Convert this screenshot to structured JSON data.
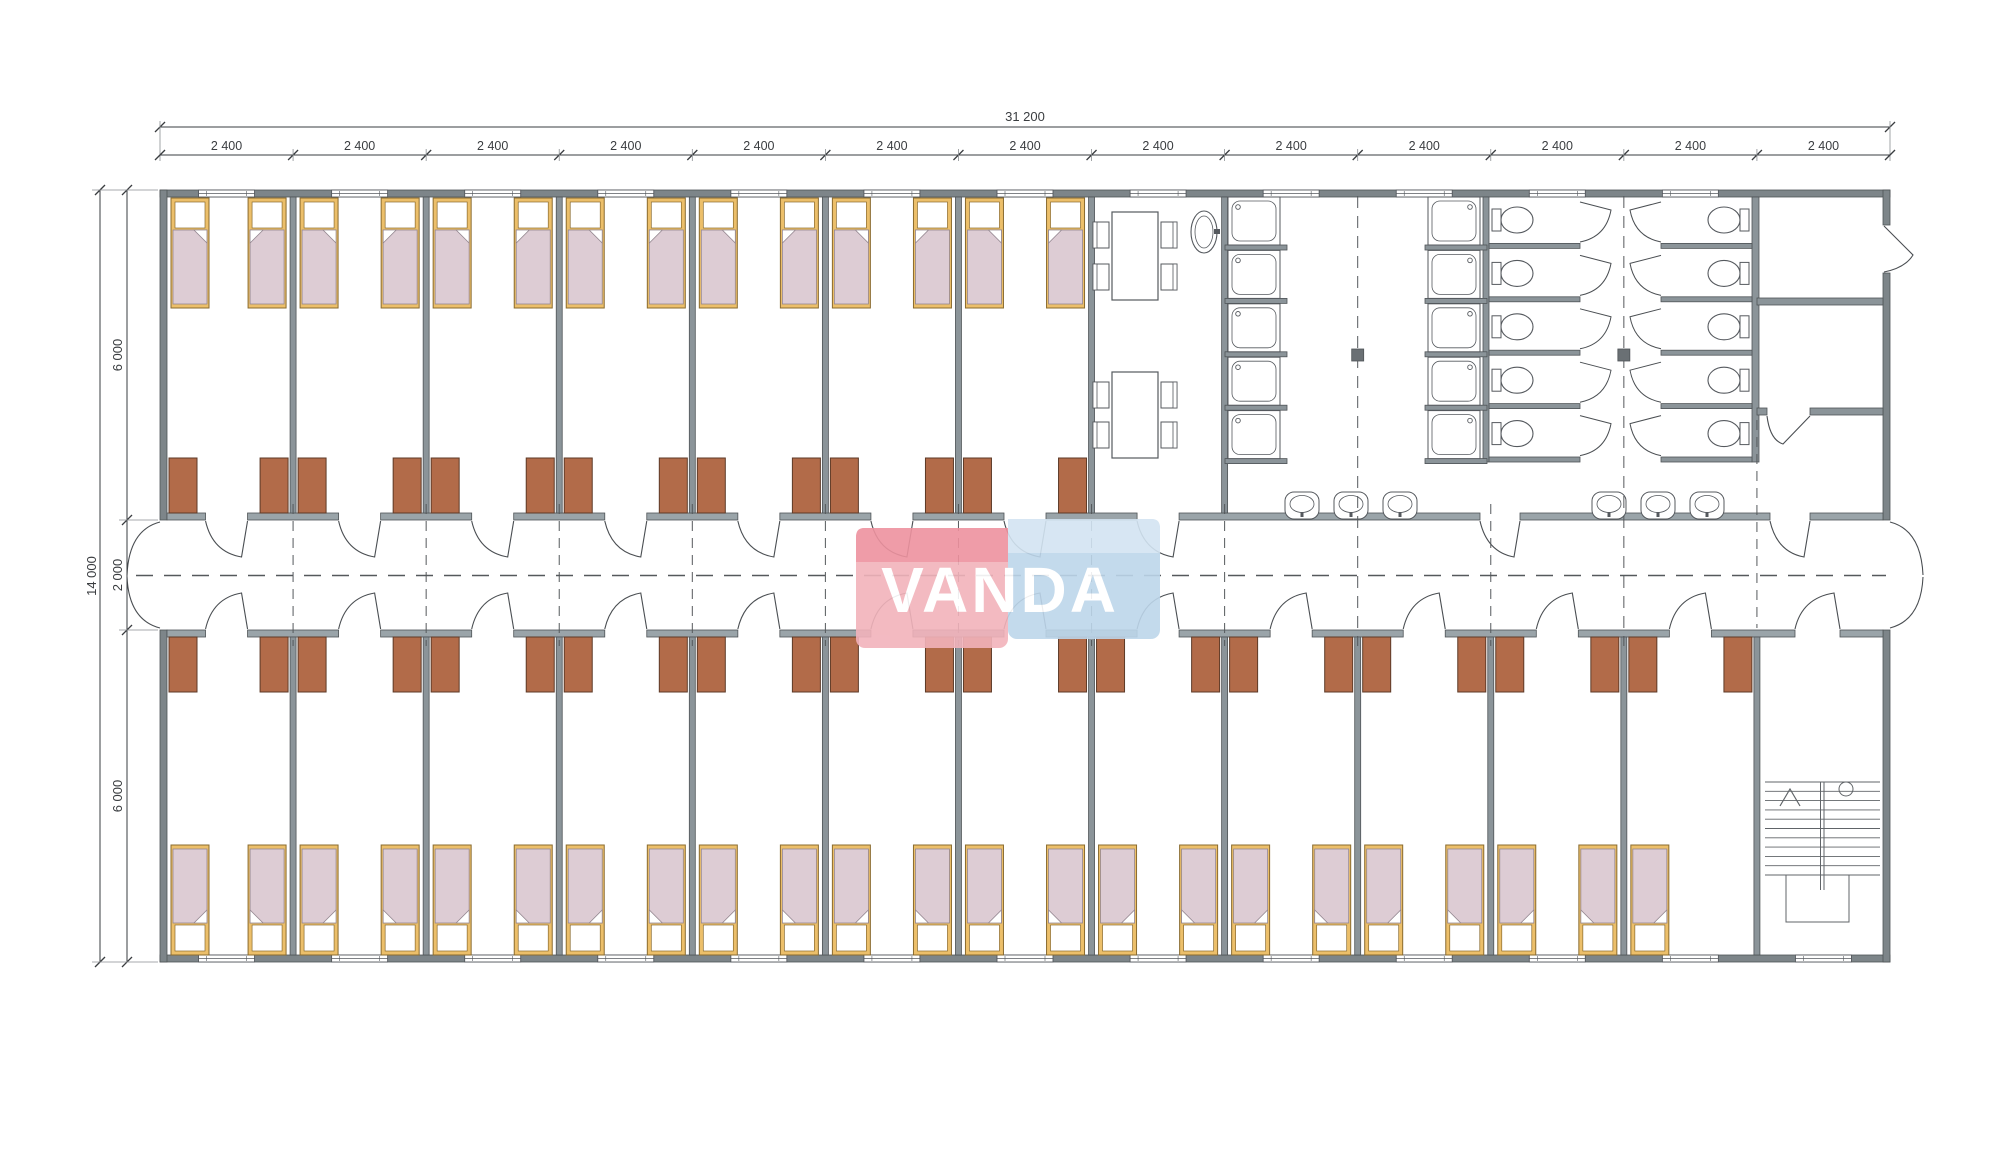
{
  "watermark": {
    "text": "VANDA",
    "pink_face": "#f2b3bb",
    "pink_top": "#ee929f",
    "blue_face": "#bdd6ea",
    "blue_top": "#d3e4f2"
  },
  "dimensions": {
    "total_width_label": "31 200",
    "module_width_label": "2 400",
    "module_count": 13,
    "total_height_label": "14 000",
    "left_segment_labels": [
      "6 000",
      "2 000",
      "6 000"
    ]
  },
  "colors": {
    "background": "#ffffff",
    "wall_exterior": "#7d8589",
    "wall_partition": "#8b9499",
    "wall_corridor": "#9aa4a9",
    "wall_outline": "#4f5457",
    "bed_frame": "#ecbf6a",
    "bed_frame_outline": "#8a6b2f",
    "bed_blanket": "#ddccd4",
    "bed_blanket_outline": "#948790",
    "pillow": "#ffffff",
    "wardrobe": "#b26b49",
    "wardrobe_outline": "#5d3a27",
    "fixture_outline": "#55595e",
    "fixture_fill": "#ffffff",
    "door_arc": "#4a4e52",
    "dashed_line": "#55595c",
    "dimension_line": "#3a3d40",
    "column_fill": "#6a7074",
    "stair_line": "#606468"
  },
  "plan": {
    "bedrooms_top": 7,
    "bedrooms_bottom": 12,
    "beds_top": 14,
    "beds_bottom": 23,
    "shower_columns": 2,
    "showers_per_column": 5,
    "toilet_blocks": 2,
    "toilets_per_block": 5,
    "washbasin_groups": 2,
    "washbasins_per_group": 3,
    "canteen_tables": 2,
    "chairs_per_table": 4,
    "corridor_exit_doors": 2,
    "staircase": 1
  }
}
